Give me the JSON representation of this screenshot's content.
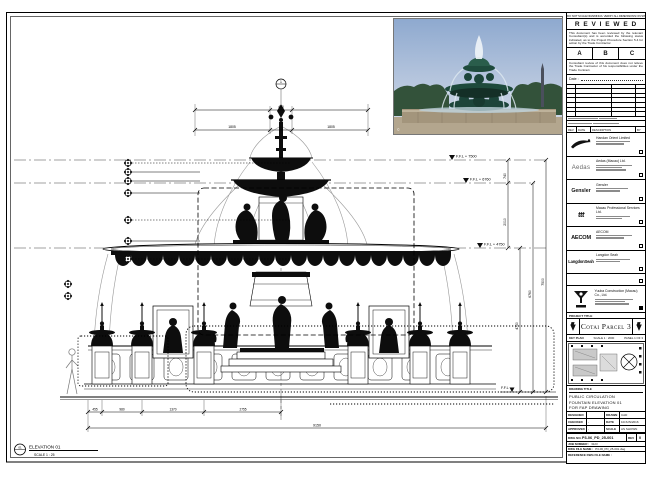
{
  "sheet": {
    "note_strip": "DO NOT SCALE DRAWINGS. VERIFY ALL DIMENSIONS ON SITE.",
    "elevation_bubble": "01",
    "elevation_label": "ELEVATION 01",
    "elevation_scale": "SCALE 1 : 25"
  },
  "reviewed": {
    "title": "R E V I E W E D",
    "para1": "This document has been reviewed by the relevant Consultant(s) and is accorded the following status indicated, as to the Project Procedure Section 5.4 for action by the Trade Contractor.",
    "options": [
      "A",
      "B",
      "C"
    ],
    "para2": "Consultant review of this document does not relieve the Trade Contractor of his responsibilities under the Trade Contract.",
    "date_label": "Date :"
  },
  "rev_strip": [
    "REV",
    "DATE",
    "DESCRIPTION",
    "BY"
  ],
  "consultants": [
    {
      "logo": "",
      "name": "Handan Orient Limited"
    },
    {
      "logo": "Aedas",
      "name": "Aedas (Macau) Ltd."
    },
    {
      "logo": "Gensler",
      "name": "Gensler"
    },
    {
      "logo": "ttt",
      "name": "Macau Professional Services Ltd."
    },
    {
      "logo": "AECOM",
      "name": "AECOM"
    },
    {
      "logo": "LangdonSeah",
      "name": "Langdon Seah"
    }
  ],
  "contractor": {
    "name": "Yuuba Construction (Macau) Co., Ltd."
  },
  "project": {
    "header": "PROJECT TITLE",
    "title": "Cotai Parcel 3"
  },
  "key_plan": {
    "label": "KEY PLAN",
    "scale": "SCALE 1 : 2000",
    "panel": "PANEL 1 OF 3"
  },
  "title_block": {
    "drawing_title_label": "DRAWING TITLE",
    "title_lines": [
      "PUBLIC CIRCULATION",
      "FOUNTAIN ELEVATION 01",
      "FOR FAP DRAWING"
    ],
    "designed_label": "DESIGNED",
    "designed": "",
    "drawn_label": "DRAWN",
    "drawn": "CAD",
    "checked_label": "CHECKED",
    "checked": "-",
    "date_label": "DATE",
    "date": "10/JUN/2016",
    "approved_label": "APPROVED",
    "approved": "-",
    "scale_label": "SCALE",
    "scale": "AS SHOWN",
    "dwg_no_label": "DWG NO.",
    "dwg_no": "P3-06_PD_25-001",
    "rev_label": "REV",
    "rev": "0",
    "job_label": "JOB NUMBER :",
    "job": "3123",
    "file_label": "DWG FILE NAME :",
    "file": "P3-06_PD_25-001.dwg",
    "ref_label": "REFERENCE DWG FILE NAME :",
    "ref": ""
  },
  "drawing": {
    "bubble": "1",
    "levels": [
      "F.F.L + 7500",
      "F.F.L + 6760",
      "F.F.L + 4750"
    ],
    "ffl": "F.F.L",
    "dims": {
      "top_center": "450",
      "top_left": "1805",
      "top_right": "1805",
      "right_740": "740",
      "right_2010": "2010",
      "right_4750": "4750",
      "right_6760": "6760",
      "right_7500": "7500",
      "bottom": [
        "455",
        "980",
        "1370",
        "2755"
      ],
      "overall": "9150"
    }
  },
  "photo": {
    "caption": "©"
  }
}
